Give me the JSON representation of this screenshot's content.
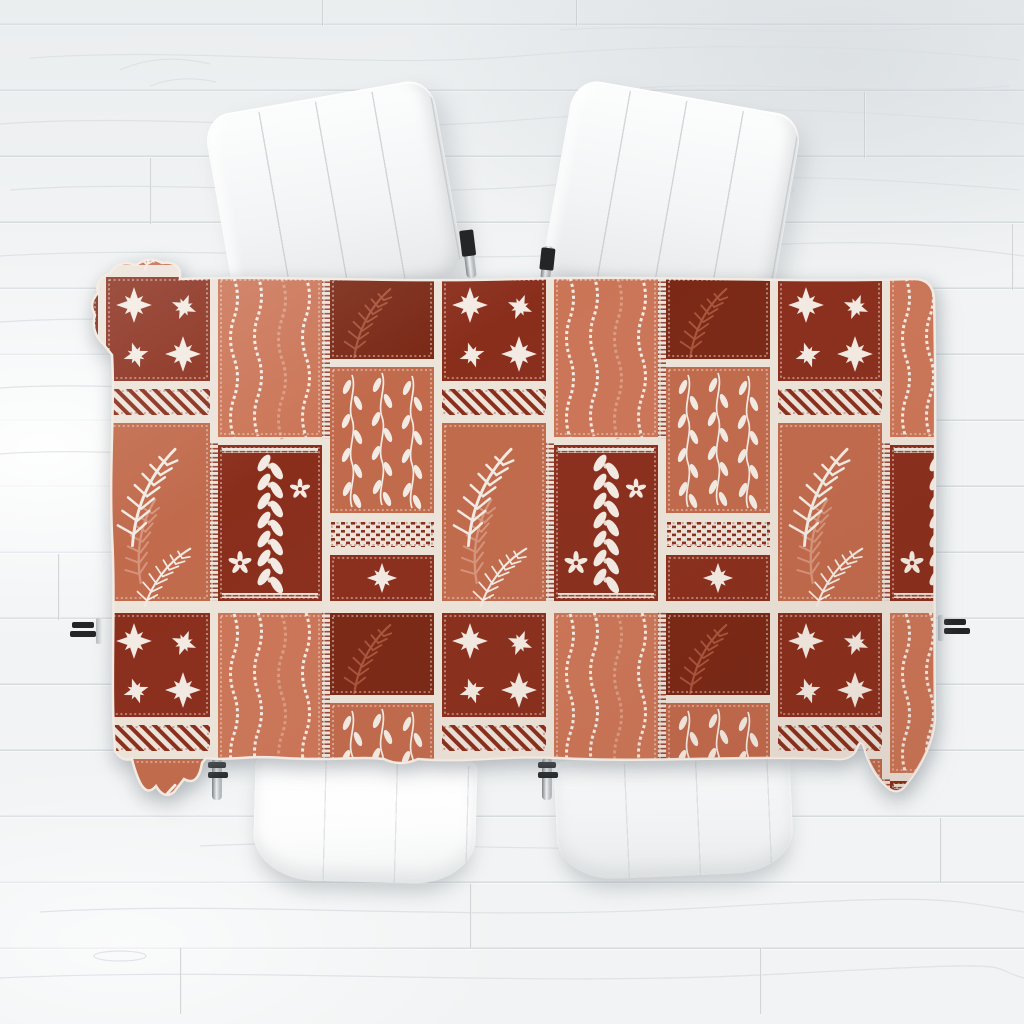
{
  "scene": {
    "description": "Top-down product photo mockup: a rectangular tablecloth with a Hawaiian tapa patchwork print draped over a table, two white chair backrests at the top, two white chair seats at the bottom, on a whitewashed wood plank floor",
    "product": {
      "name": "Tablecloth",
      "print_style": "Hawaiian tapa / quilt patchwork",
      "shape": "rectangular with softly draped, jagged corner flaps",
      "view": "directly from above"
    },
    "pattern_motifs": [
      "fern-frond",
      "crown-flower-lei-garland",
      "maile-vine-leaves",
      "hawaiian-quilt-snowflake-medallion",
      "wavy-dotted-water-lines",
      "diagonal-stripe-band",
      "checker-band",
      "ladder-stripe-strip",
      "plumeria-flower-cluster"
    ],
    "furniture": {
      "top_chairs": 2,
      "bottom_chairs": 2,
      "chair_color": "white",
      "leg_fittings": "chrome tubes with black fittings"
    },
    "floor": {
      "material": "whitewashed oak planks",
      "plank_direction": "horizontal"
    },
    "palette": {
      "floor_base": "#f1f3f4",
      "plank_line": "#d6dbde",
      "plank_highlight": "#ffffff",
      "floor_grain": "#d9dfe2",
      "floor_shade": "#cdd3d7",
      "cloth_cream": "#ece3d9",
      "motif_white": "#f3ebe3",
      "salmon": "#cb7557",
      "terracotta": "#c16a4c",
      "maroon": "#8a2e1c",
      "maroon_deep": "#7a2815",
      "tone_rose": "#d99b82",
      "tone_maroon": "#a9553c",
      "chair_white": "#fcfdfd",
      "chair_mid": "#f3f4f5",
      "chair_shadow": "#e7e9ea",
      "chrome_light": "#eef0f1",
      "chrome_mid": "#b6babd",
      "chrome_dark": "#7e8386",
      "hardware_black": "#232526"
    }
  }
}
